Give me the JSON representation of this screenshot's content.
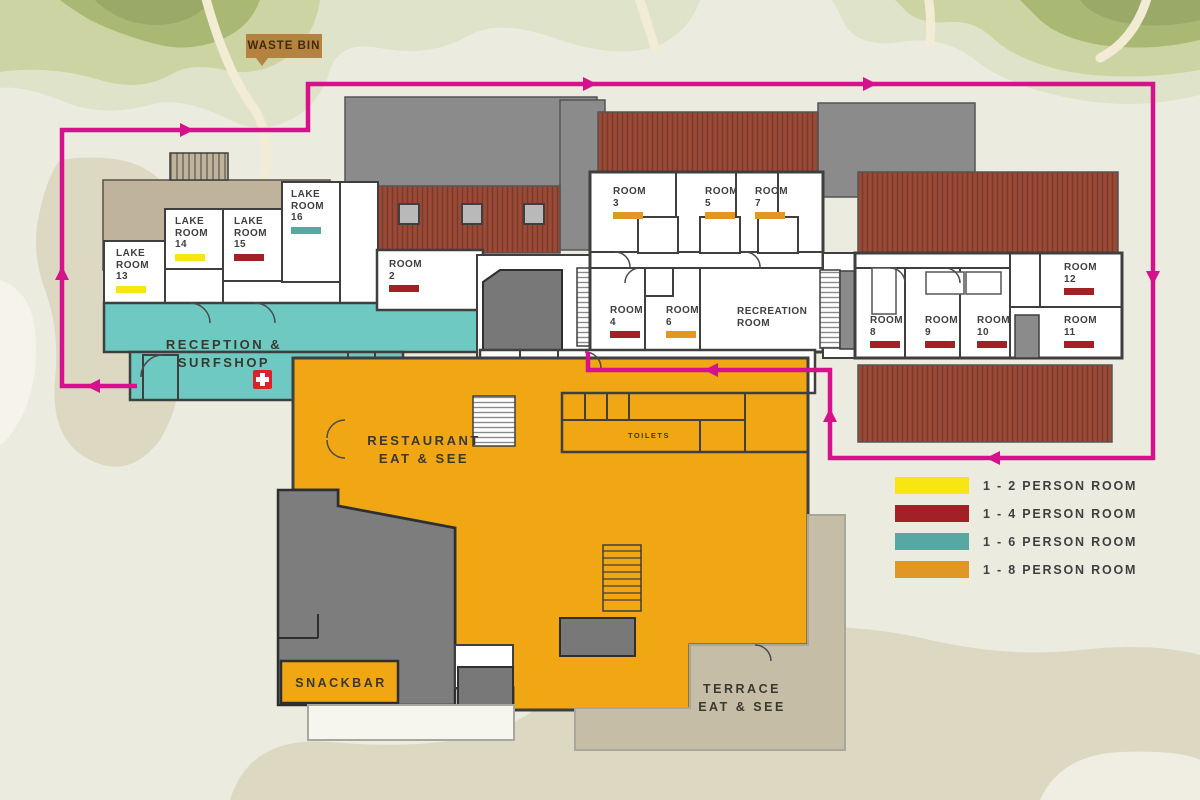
{
  "map": {
    "waste_bin_label": "WASTE BIN",
    "zones": {
      "reception": {
        "lines": [
          "RECEPTION &",
          "SURFSHOP"
        ]
      },
      "restaurant": {
        "lines": [
          "RESTAURANT",
          "EAT & SEE"
        ]
      },
      "terrace": {
        "lines": [
          "TERRACE",
          "EAT & SEE"
        ]
      },
      "snackbar": {
        "lines": [
          "SNACKBAR"
        ]
      },
      "toilets": {
        "lines": [
          "TOILETS"
        ]
      }
    },
    "rooms": [
      {
        "id": "lake-room-13",
        "lines": [
          "LAKE",
          "ROOM",
          "13"
        ],
        "category": "p2",
        "x": 116,
        "y": 248
      },
      {
        "id": "lake-room-14",
        "lines": [
          "LAKE",
          "ROOM",
          "14"
        ],
        "category": "p2",
        "x": 175,
        "y": 216
      },
      {
        "id": "lake-room-15",
        "lines": [
          "LAKE",
          "ROOM",
          "15"
        ],
        "category": "p4",
        "x": 234,
        "y": 216
      },
      {
        "id": "lake-room-16",
        "lines": [
          "LAKE",
          "ROOM",
          "16"
        ],
        "category": "p6",
        "x": 291,
        "y": 189
      },
      {
        "id": "room-2",
        "lines": [
          "ROOM",
          "2"
        ],
        "category": "p4",
        "x": 389,
        "y": 259
      },
      {
        "id": "room-3",
        "lines": [
          "ROOM",
          "3"
        ],
        "category": "p8",
        "x": 613,
        "y": 186
      },
      {
        "id": "room-5",
        "lines": [
          "ROOM",
          "5"
        ],
        "category": "p8",
        "x": 705,
        "y": 186
      },
      {
        "id": "room-7",
        "lines": [
          "ROOM",
          "7"
        ],
        "category": "p8",
        "x": 755,
        "y": 186
      },
      {
        "id": "room-4",
        "lines": [
          "ROOM",
          "4"
        ],
        "category": "p4",
        "x": 610,
        "y": 305
      },
      {
        "id": "room-6",
        "lines": [
          "ROOM",
          "6"
        ],
        "category": "p8",
        "x": 666,
        "y": 305
      },
      {
        "id": "recreation-room",
        "lines": [
          "RECREATION",
          "ROOM"
        ],
        "category": null,
        "x": 737,
        "y": 306
      },
      {
        "id": "room-8",
        "lines": [
          "ROOM",
          "8"
        ],
        "category": "p4",
        "x": 870,
        "y": 315
      },
      {
        "id": "room-9",
        "lines": [
          "ROOM",
          "9"
        ],
        "category": "p4",
        "x": 925,
        "y": 315
      },
      {
        "id": "room-10",
        "lines": [
          "ROOM",
          "10"
        ],
        "category": "p4",
        "x": 977,
        "y": 315
      },
      {
        "id": "room-11",
        "lines": [
          "ROOM",
          "11"
        ],
        "category": "p4",
        "x": 1064,
        "y": 315
      },
      {
        "id": "room-12",
        "lines": [
          "ROOM",
          "12"
        ],
        "category": "p4",
        "x": 1064,
        "y": 262
      }
    ]
  },
  "legend": {
    "items": [
      {
        "label": "1 - 2 PERSON ROOM",
        "color": "#f8e612"
      },
      {
        "label": "1 - 4 PERSON ROOM",
        "color": "#a32126"
      },
      {
        "label": "1 - 6 PERSON ROOM",
        "color": "#57a8a2"
      },
      {
        "label": "1 - 8 PERSON ROOM",
        "color": "#e09723"
      }
    ]
  },
  "colors": {
    "p2": "#f8e612",
    "p4": "#a32126",
    "p6": "#57a8a2",
    "p8": "#e09723",
    "route": "#d6118c",
    "teal_floor": "#6fc9c3",
    "orange_floor": "#f1a714"
  }
}
